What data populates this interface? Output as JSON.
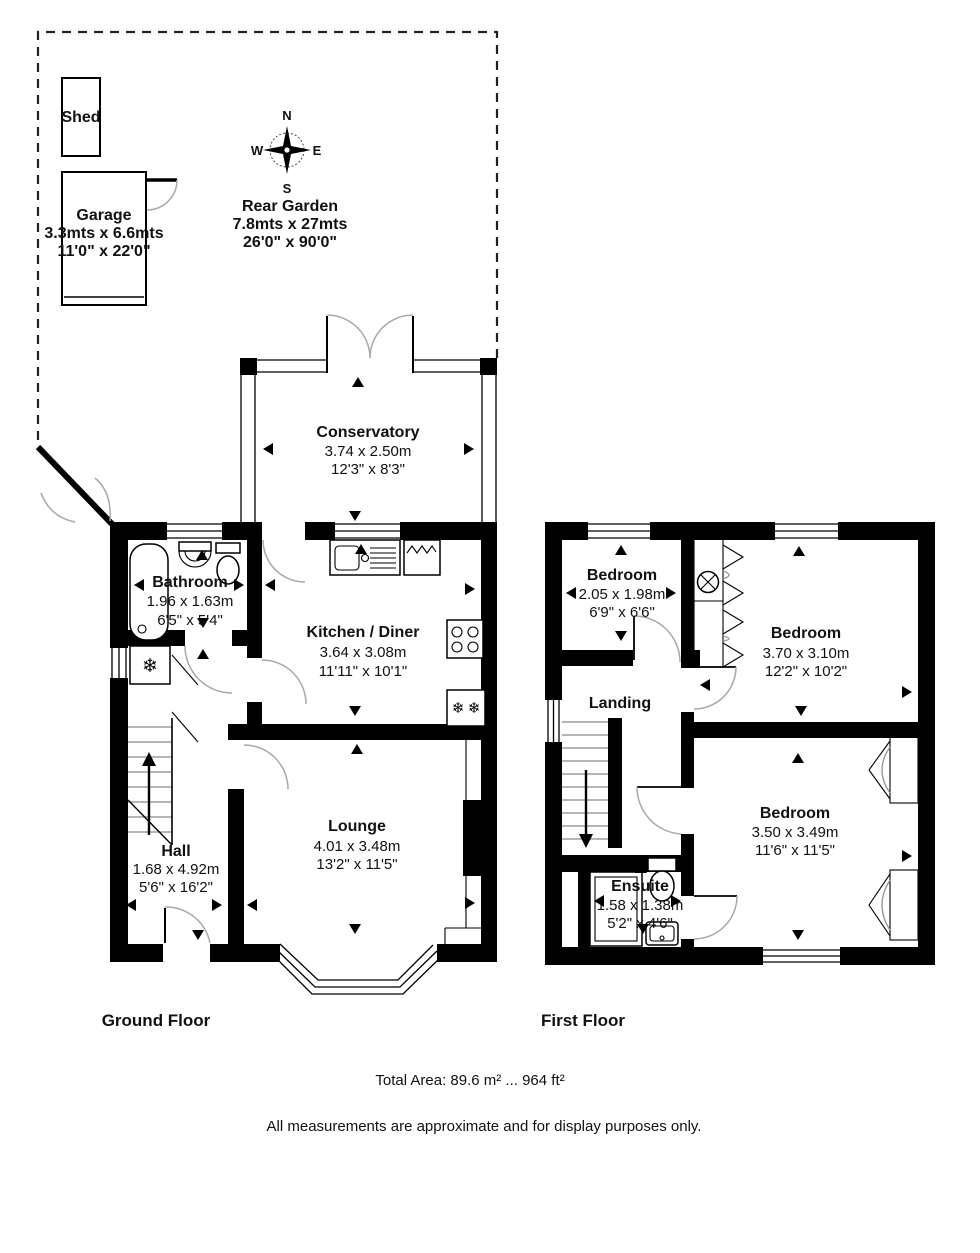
{
  "garden": {
    "shed": {
      "name": "Shed"
    },
    "garage": {
      "name": "Garage",
      "metric": "3.3mts x 6.6mts",
      "imperial": "11'0\" x 22'0\""
    },
    "rear_garden": {
      "name": "Rear Garden",
      "metric": "7.8mts x 27mts",
      "imperial": "26'0\" x 90'0\""
    },
    "compass": {
      "north": "N",
      "east": "E",
      "south": "S",
      "west": "W"
    }
  },
  "ground_floor": {
    "title": "Ground Floor",
    "conservatory": {
      "name": "Conservatory",
      "metric": "3.74 x 2.50m",
      "imperial": "12'3\" x 8'3\""
    },
    "bathroom": {
      "name": "Bathroom",
      "metric": "1.96 x 1.63m",
      "imperial": "6'5\" x 5'4\""
    },
    "kitchen_diner": {
      "name": "Kitchen / Diner",
      "metric": "3.64 x 3.08m",
      "imperial": "11'11\" x 10'1\""
    },
    "hall": {
      "name": "Hall",
      "metric": "1.68 x 4.92m",
      "imperial": "5'6\" x 16'2\""
    },
    "lounge": {
      "name": "Lounge",
      "metric": "4.01 x 3.48m",
      "imperial": "13'2\" x 11'5\""
    }
  },
  "first_floor": {
    "title": "First Floor",
    "bedroom_small": {
      "name": "Bedroom",
      "metric": "2.05 x 1.98m",
      "imperial": "6'9\" x 6'6\""
    },
    "bedroom_rear": {
      "name": "Bedroom",
      "metric": "3.70 x 3.10m",
      "imperial": "12'2\" x 10'2\""
    },
    "bedroom_front": {
      "name": "Bedroom",
      "metric": "3.50 x 3.49m",
      "imperial": "11'6\" x 11'5\""
    },
    "landing": {
      "name": "Landing"
    },
    "ensuite": {
      "name": "Ensuite",
      "metric": "1.58 x 1.38m",
      "imperial": "5'2\" x 4'6\""
    }
  },
  "footer": {
    "total_area": "Total Area: 89.6 m² ... 964 ft²",
    "disclaimer": "All measurements are approximate and for display purposes only."
  },
  "icons": {
    "freezer": "❄"
  },
  "colors": {
    "wall": "#000000",
    "background": "#ffffff",
    "door_arc": "#a8a8a8"
  }
}
